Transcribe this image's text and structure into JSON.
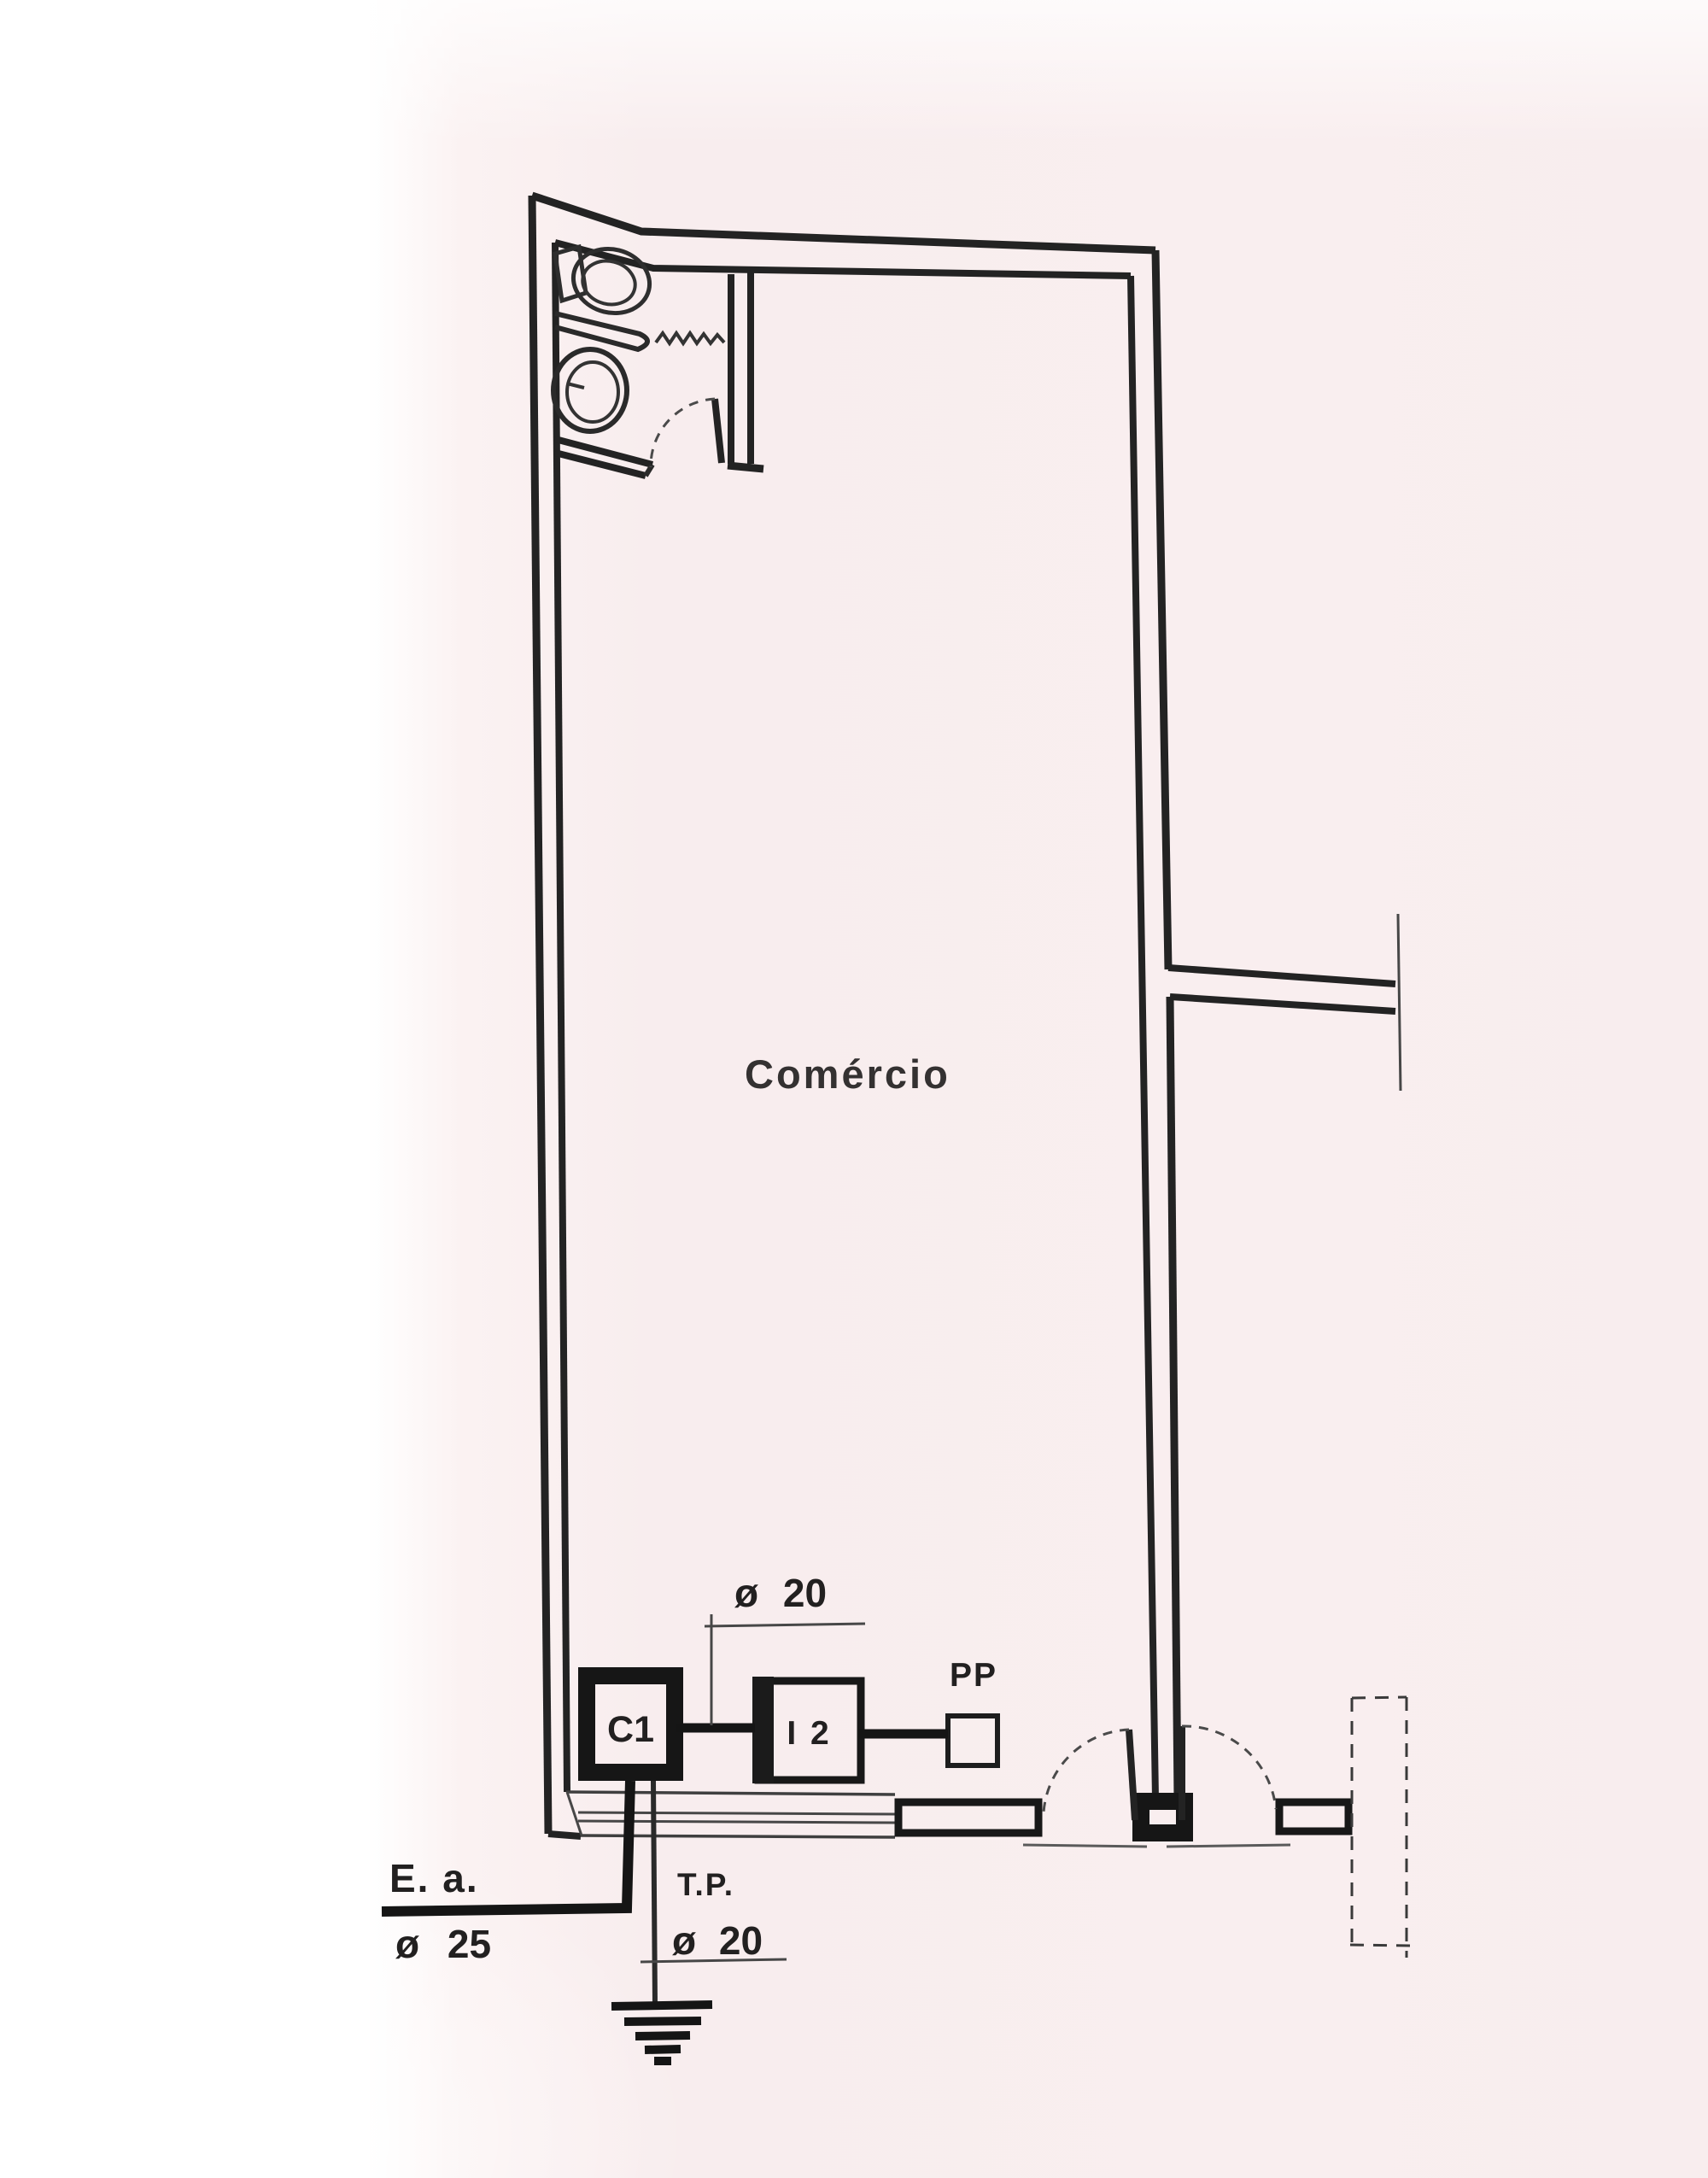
{
  "drawing": {
    "room_label": "Comércio",
    "annotations": {
      "circuit_dim": "ø 20",
      "pp_label": "PP",
      "c1_label": "C1",
      "i2_label": "I 2",
      "service_entrance_label": "E. a.",
      "service_entrance_dim": "ø 25",
      "tp_label": "T.P.",
      "tp_dim": "ø 20"
    },
    "colors": {
      "paper": "#f8edee",
      "ink": "#232323",
      "ink_light": "#4a4a4a"
    }
  }
}
